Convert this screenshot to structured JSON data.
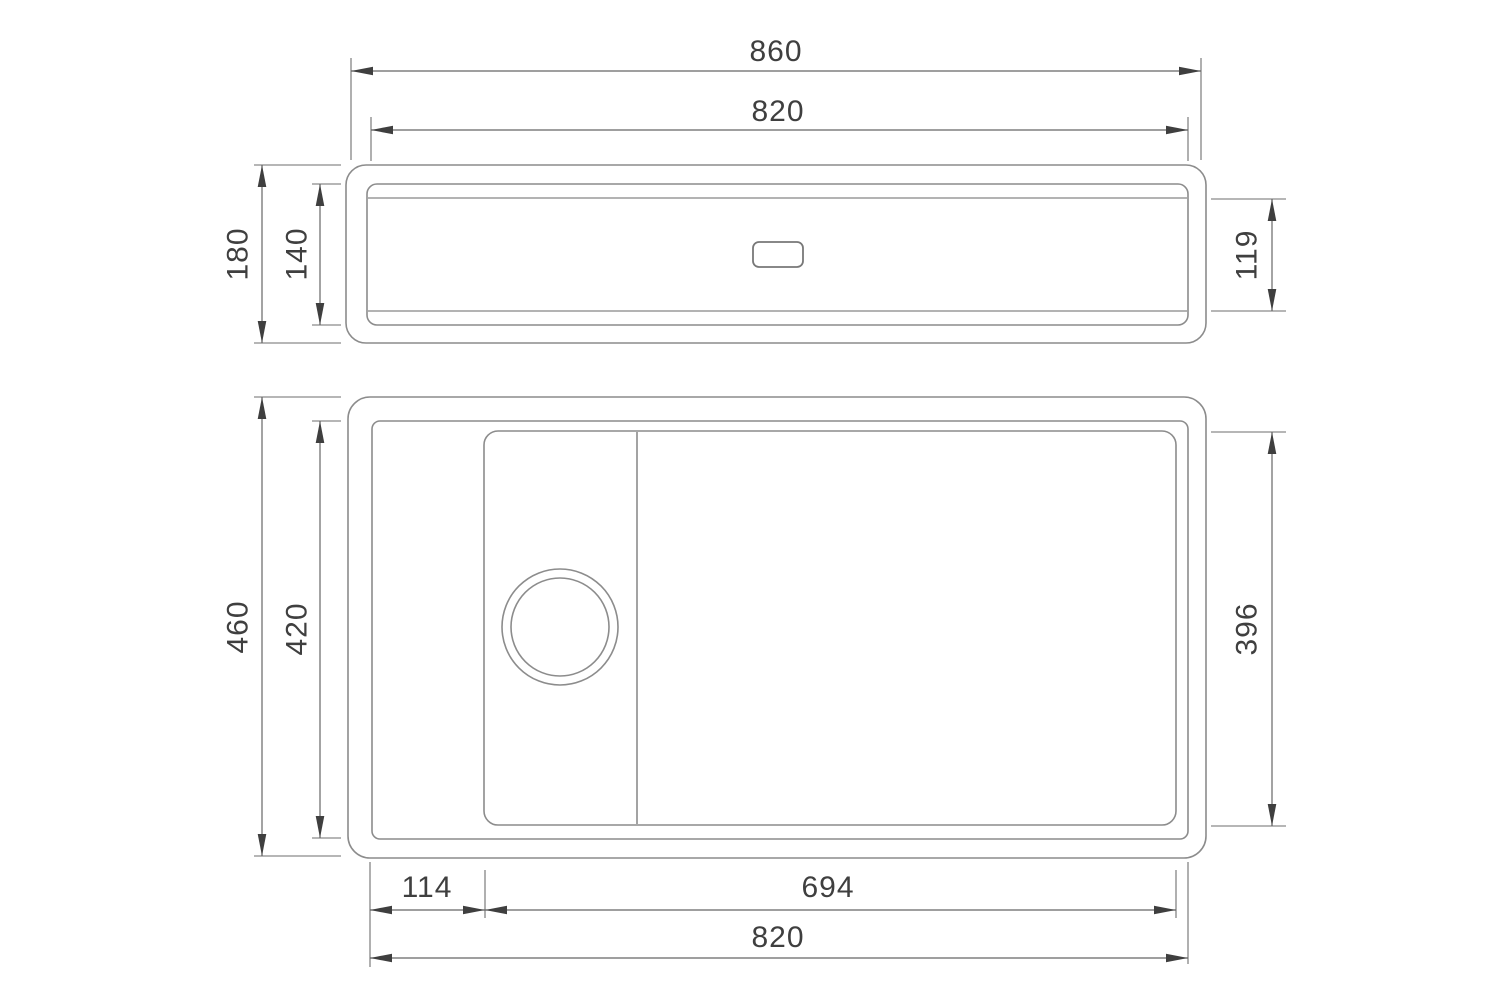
{
  "drawing_type": "technical-dimension-drawing",
  "subject": "kitchen sink with drainer ledge, two orthographic views",
  "units_implied": "mm",
  "colors": {
    "background": "#ffffff",
    "object_line": "#8c8c8c",
    "dimension_line": "#666666",
    "text": "#3f3f3f"
  },
  "views": {
    "side": {
      "name": "side-elevation-view",
      "dimensions": {
        "overall_width": "860",
        "inner_width": "820",
        "overall_height": "180",
        "inner_height": "140",
        "basin_height": "119"
      }
    },
    "plan": {
      "name": "top-plan-view",
      "dimensions": {
        "overall_depth": "460",
        "inner_depth": "420",
        "bowl_depth": "396",
        "ledge_width": "114",
        "bowl_width": "694",
        "inner_width": "820"
      }
    }
  }
}
